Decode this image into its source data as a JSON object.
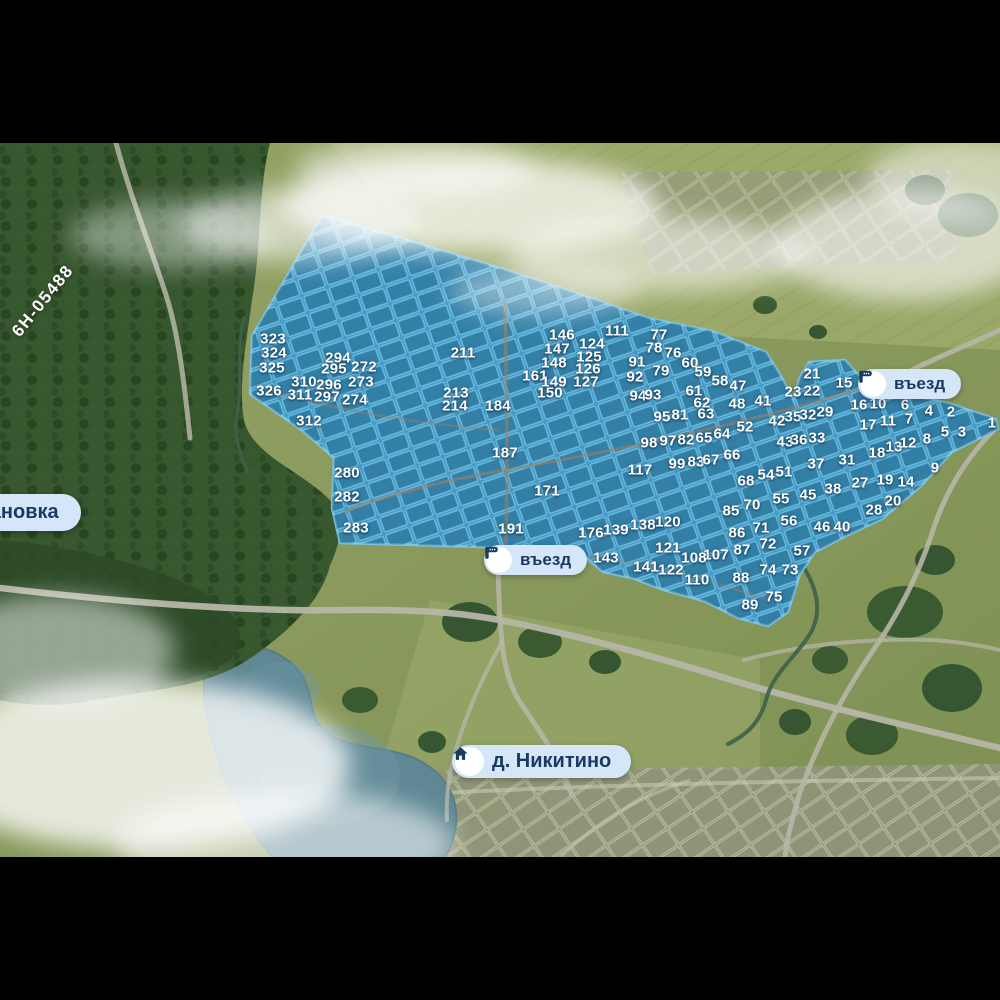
{
  "map_labels": {
    "entrance_top": "въезд",
    "entrance_bottom": "въезд",
    "village": "д. Никитино",
    "bus_stop": "тановка",
    "road_code": "6Н-05488"
  },
  "colors": {
    "estate_fill": "#3f9cd0",
    "estate_border": "#7dc6ee",
    "pill_bg": "#d4e6f7",
    "pill_text": "#1b3a63",
    "field": "#8d9c60",
    "forest": "#37572f",
    "water": "#5f8794",
    "road": "#b6b6a6",
    "fog": "#ffffff"
  },
  "plots": [
    [
      "323",
      273,
      339
    ],
    [
      "324",
      274,
      353
    ],
    [
      "325",
      272,
      368
    ],
    [
      "326",
      269,
      391
    ],
    [
      "294",
      338,
      358
    ],
    [
      "295",
      334,
      369
    ],
    [
      "310",
      304,
      382
    ],
    [
      "296",
      329,
      385
    ],
    [
      "311",
      300,
      395
    ],
    [
      "297",
      327,
      397
    ],
    [
      "272",
      364,
      367
    ],
    [
      "273",
      361,
      382
    ],
    [
      "274",
      355,
      400
    ],
    [
      "312",
      309,
      421
    ],
    [
      "211",
      463,
      353
    ],
    [
      "213",
      456,
      393
    ],
    [
      "214",
      455,
      406
    ],
    [
      "184",
      498,
      406
    ],
    [
      "187",
      505,
      453
    ],
    [
      "280",
      347,
      473
    ],
    [
      "282",
      347,
      497
    ],
    [
      "283",
      356,
      528
    ],
    [
      "191",
      511,
      529
    ],
    [
      "171",
      547,
      491
    ],
    [
      "146",
      562,
      335
    ],
    [
      "147",
      557,
      349
    ],
    [
      "148",
      554,
      363
    ],
    [
      "161",
      535,
      376
    ],
    [
      "149",
      554,
      382
    ],
    [
      "150",
      550,
      393
    ],
    [
      "124",
      592,
      344
    ],
    [
      "125",
      589,
      357
    ],
    [
      "126",
      588,
      369
    ],
    [
      "127",
      586,
      382
    ],
    [
      "111",
      617,
      331
    ],
    [
      "91",
      637,
      362
    ],
    [
      "92",
      635,
      377
    ],
    [
      "77",
      659,
      335
    ],
    [
      "78",
      654,
      348
    ],
    [
      "76",
      673,
      353
    ],
    [
      "60",
      690,
      363
    ],
    [
      "59",
      703,
      372
    ],
    [
      "79",
      661,
      371
    ],
    [
      "58",
      720,
      381
    ],
    [
      "47",
      738,
      386
    ],
    [
      "94",
      638,
      396
    ],
    [
      "93",
      653,
      395
    ],
    [
      "61",
      694,
      391
    ],
    [
      "62",
      702,
      403
    ],
    [
      "63",
      706,
      414
    ],
    [
      "48",
      737,
      404
    ],
    [
      "41",
      763,
      401
    ],
    [
      "95",
      662,
      417
    ],
    [
      "81",
      680,
      415
    ],
    [
      "98",
      649,
      443
    ],
    [
      "97",
      668,
      441
    ],
    [
      "82",
      686,
      440
    ],
    [
      "65",
      704,
      438
    ],
    [
      "64",
      722,
      434
    ],
    [
      "52",
      745,
      427
    ],
    [
      "42",
      777,
      421
    ],
    [
      "35",
      793,
      417
    ],
    [
      "32",
      808,
      415
    ],
    [
      "29",
      825,
      412
    ],
    [
      "21",
      812,
      374
    ],
    [
      "23",
      793,
      392
    ],
    [
      "22",
      812,
      391
    ],
    [
      "15",
      844,
      383
    ],
    [
      "16",
      859,
      405
    ],
    [
      "10",
      878,
      404
    ],
    [
      "6",
      905,
      405
    ],
    [
      "4",
      929,
      411
    ],
    [
      "2",
      951,
      412
    ],
    [
      "1",
      992,
      423
    ],
    [
      "17",
      868,
      425
    ],
    [
      "11",
      888,
      421
    ],
    [
      "7",
      909,
      419
    ],
    [
      "5",
      945,
      432
    ],
    [
      "3",
      962,
      432
    ],
    [
      "43",
      785,
      442
    ],
    [
      "36",
      799,
      440
    ],
    [
      "33",
      817,
      438
    ],
    [
      "18",
      877,
      453
    ],
    [
      "13",
      894,
      447
    ],
    [
      "12",
      908,
      443
    ],
    [
      "8",
      927,
      439
    ],
    [
      "31",
      847,
      460
    ],
    [
      "9",
      935,
      468
    ],
    [
      "117",
      640,
      470
    ],
    [
      "99",
      677,
      464
    ],
    [
      "83",
      696,
      462
    ],
    [
      "67",
      711,
      460
    ],
    [
      "66",
      732,
      455
    ],
    [
      "37",
      816,
      464
    ],
    [
      "68",
      746,
      481
    ],
    [
      "54",
      766,
      475
    ],
    [
      "51",
      784,
      472
    ],
    [
      "55",
      781,
      499
    ],
    [
      "45",
      808,
      495
    ],
    [
      "38",
      833,
      489
    ],
    [
      "27",
      860,
      483
    ],
    [
      "19",
      885,
      480
    ],
    [
      "14",
      906,
      482
    ],
    [
      "28",
      874,
      510
    ],
    [
      "20",
      893,
      501
    ],
    [
      "85",
      731,
      511
    ],
    [
      "70",
      752,
      505
    ],
    [
      "86",
      737,
      533
    ],
    [
      "71",
      761,
      528
    ],
    [
      "56",
      789,
      521
    ],
    [
      "46",
      822,
      527
    ],
    [
      "40",
      842,
      527
    ],
    [
      "72",
      768,
      544
    ],
    [
      "87",
      742,
      550
    ],
    [
      "107",
      716,
      555
    ],
    [
      "108",
      694,
      558
    ],
    [
      "57",
      802,
      551
    ],
    [
      "176",
      591,
      533
    ],
    [
      "139",
      616,
      530
    ],
    [
      "138",
      643,
      525
    ],
    [
      "120",
      668,
      522
    ],
    [
      "143",
      606,
      558
    ],
    [
      "121",
      668,
      548
    ],
    [
      "141",
      646,
      567
    ],
    [
      "122",
      671,
      570
    ],
    [
      "110",
      697,
      580
    ],
    [
      "88",
      741,
      578
    ],
    [
      "74",
      768,
      570
    ],
    [
      "73",
      790,
      570
    ],
    [
      "75",
      774,
      597
    ],
    [
      "89",
      750,
      605
    ]
  ]
}
